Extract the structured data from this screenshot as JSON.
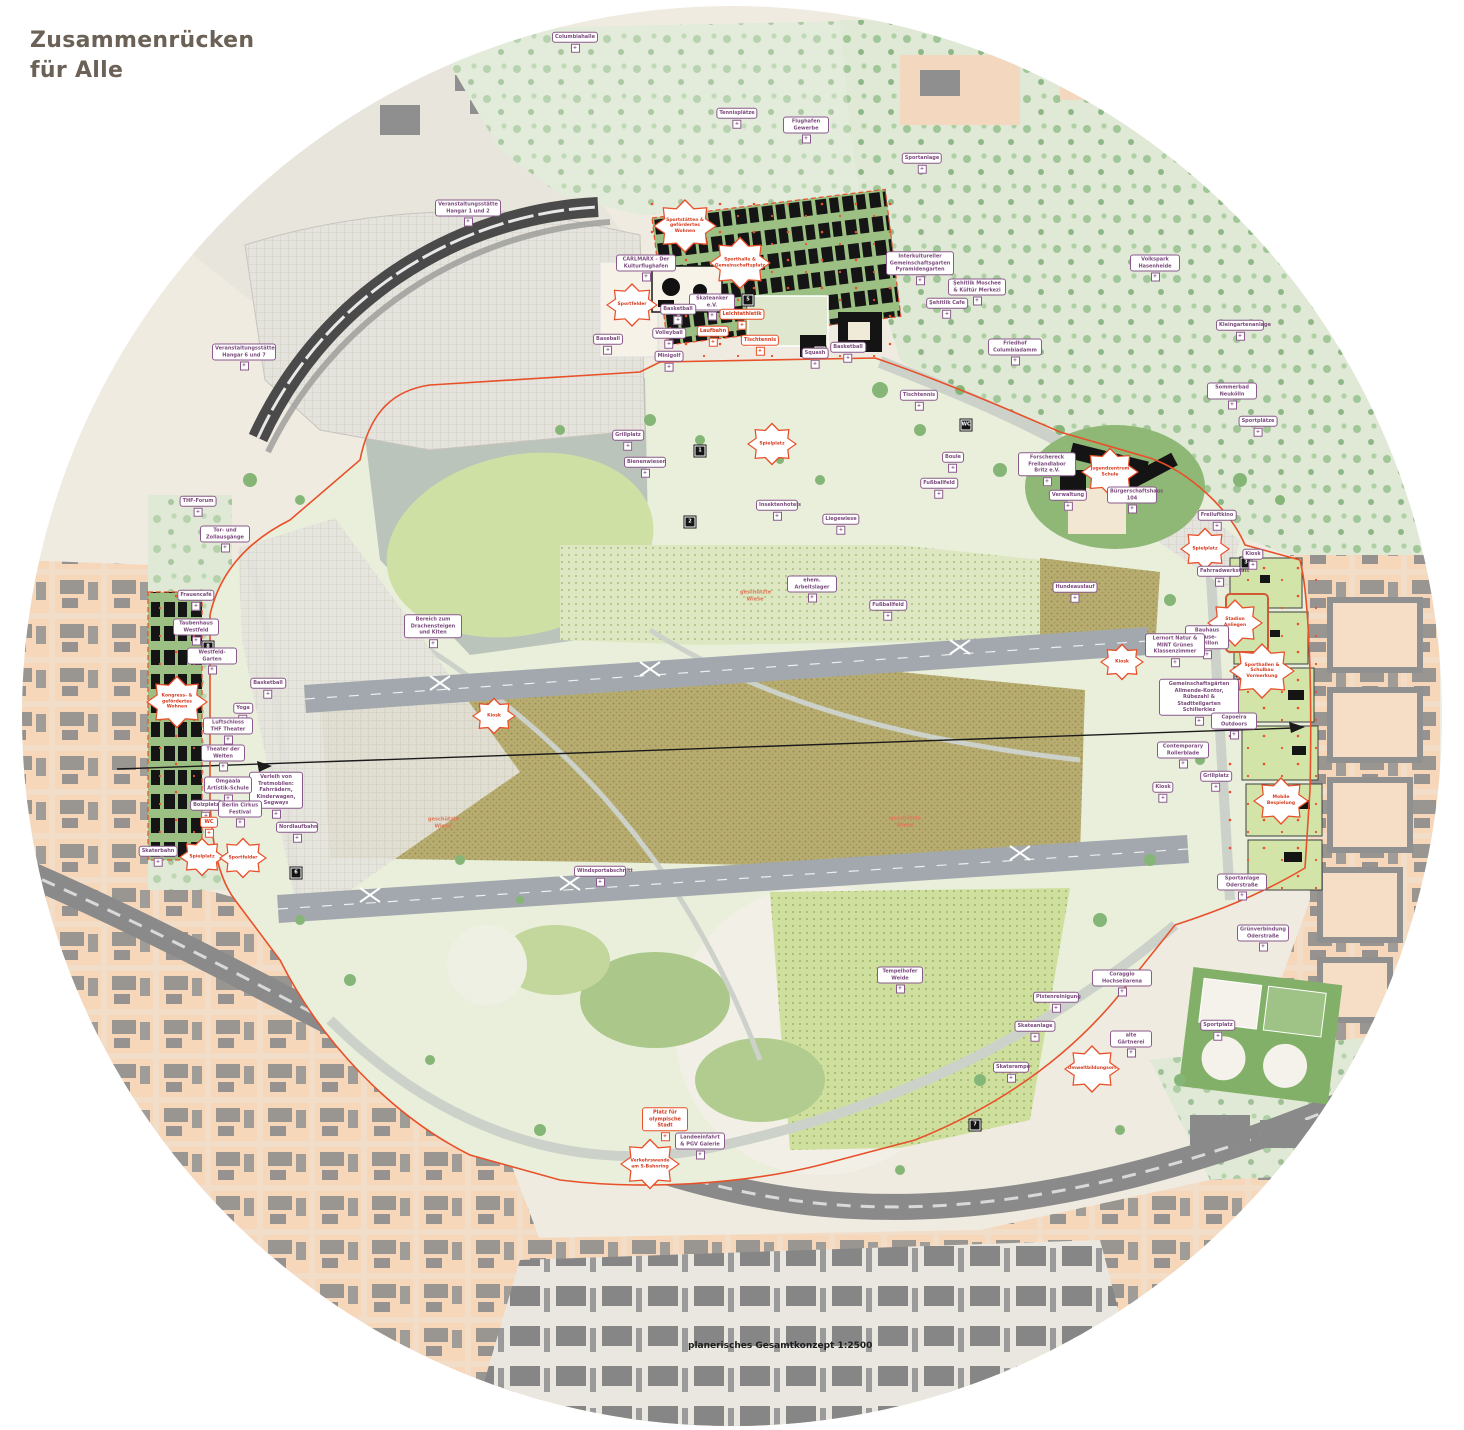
{
  "title": "Zusammenrücken\nfür Alle",
  "caption": "planerisches Gesamtkonzept  1:2500",
  "colors": {
    "accent_orange": "#e8502a",
    "label_purple": "#7b4b7d",
    "field_green": "#e9efdb",
    "meadow_brown": "#b8ad6f",
    "city_peach": "#f6d7ba",
    "title_brown": "#6b6156"
  },
  "map": {
    "labels": [
      {
        "t": "Columbiahalle",
        "x": 575,
        "y": 42,
        "k": "p"
      },
      {
        "t": "Tennisplätze",
        "x": 737,
        "y": 118,
        "k": "p"
      },
      {
        "t": "Flughafen Gewerbe",
        "x": 806,
        "y": 130,
        "k": "p",
        "w": 40
      },
      {
        "t": "Sportanlage",
        "x": 922,
        "y": 163,
        "k": "p"
      },
      {
        "t": "Volkspark Hasenheide",
        "x": 1155,
        "y": 268,
        "k": "p",
        "w": 44
      },
      {
        "t": "Kleingartenanlage",
        "x": 1240,
        "y": 330,
        "k": "p",
        "w": 42
      },
      {
        "t": "Sommerbad Neukölln",
        "x": 1232,
        "y": 396,
        "k": "p",
        "w": 44
      },
      {
        "t": "Sportplätze",
        "x": 1258,
        "y": 426,
        "k": "p"
      },
      {
        "t": "Interkultureller Gemeinschaftsgarten Pyramidengarten",
        "x": 920,
        "y": 268,
        "k": "p",
        "w": 62
      },
      {
        "t": "Şehitlik Moschee & Kültür Merkezi",
        "x": 977,
        "y": 292,
        "k": "p",
        "w": 52
      },
      {
        "t": "Şehitlik Cafe",
        "x": 947,
        "y": 308,
        "k": "p"
      },
      {
        "t": "Friedhof Columbiadamm",
        "x": 1015,
        "y": 352,
        "k": "p",
        "w": 48
      },
      {
        "t": "Veranstaltungsstätte Hangar 1 und 2",
        "x": 468,
        "y": 213,
        "k": "p",
        "w": 60
      },
      {
        "t": "Veranstaltungsstätte Hangar 6 und 7",
        "x": 244,
        "y": 357,
        "k": "p",
        "w": 58
      },
      {
        "t": "THF-Forum",
        "x": 198,
        "y": 506,
        "k": "p"
      },
      {
        "t": "Tor- und Zollausgänge",
        "x": 225,
        "y": 539,
        "k": "p",
        "w": 44
      },
      {
        "t": "Sportstätten & gefördertes Wohnen",
        "x": 685,
        "y": 226,
        "k": "b",
        "w": 46
      },
      {
        "t": "Sporthalle & Gemeinschaftsplatz",
        "x": 740,
        "y": 263,
        "k": "b",
        "w": 44
      },
      {
        "t": "CARLMARX - Der Kulturflughafen",
        "x": 646,
        "y": 268,
        "k": "p",
        "w": 54
      },
      {
        "t": "Sportfelder",
        "x": 632,
        "y": 305,
        "k": "b",
        "w": 34
      },
      {
        "t": "Skateanker e.V.",
        "x": 712,
        "y": 307,
        "k": "p",
        "w": 40
      },
      {
        "t": "Basketball",
        "x": 678,
        "y": 314,
        "k": "p"
      },
      {
        "t": "Leichtathletik",
        "x": 742,
        "y": 319,
        "k": "o"
      },
      {
        "t": "Laufbahn",
        "x": 713,
        "y": 336,
        "k": "o"
      },
      {
        "t": "Volleyball",
        "x": 669,
        "y": 338,
        "k": "p"
      },
      {
        "t": "Baseball",
        "x": 608,
        "y": 344,
        "k": "p"
      },
      {
        "t": "Tischtennis",
        "x": 760,
        "y": 345,
        "k": "o"
      },
      {
        "t": "Minigolf",
        "x": 669,
        "y": 361,
        "k": "p"
      },
      {
        "t": "Squash",
        "x": 815,
        "y": 358,
        "k": "p"
      },
      {
        "t": "Basketball",
        "x": 848,
        "y": 352,
        "k": "p"
      },
      {
        "t": "Tischtennis",
        "x": 919,
        "y": 400,
        "k": "p"
      },
      {
        "t": "Boule",
        "x": 953,
        "y": 462,
        "k": "p"
      },
      {
        "t": "Fußballfeld",
        "x": 939,
        "y": 488,
        "k": "p"
      },
      {
        "t": "Forschereck Freilandlabor Britz e.V.",
        "x": 1047,
        "y": 469,
        "k": "p",
        "w": 52
      },
      {
        "t": "Jugendzentrum Schule",
        "x": 1110,
        "y": 472,
        "k": "b",
        "w": 40
      },
      {
        "t": "Verwaltung",
        "x": 1068,
        "y": 500,
        "k": "p"
      },
      {
        "t": "Bürgerschaftshaus 104",
        "x": 1132,
        "y": 500,
        "k": "p",
        "w": 44
      },
      {
        "t": "Freiluftkino",
        "x": 1217,
        "y": 520,
        "k": "p"
      },
      {
        "t": "Spielplatz",
        "x": 1205,
        "y": 549,
        "k": "b",
        "w": 32
      },
      {
        "t": "Kiosk",
        "x": 1253,
        "y": 559,
        "k": "p"
      },
      {
        "t": "Fahrradwerkstatt",
        "x": 1219,
        "y": 576,
        "k": "p",
        "w": 38
      },
      {
        "t": "Hundeauslauf",
        "x": 1075,
        "y": 592,
        "k": "p"
      },
      {
        "t": "Kiosk",
        "x": 1122,
        "y": 662,
        "k": "b",
        "w": 26
      },
      {
        "t": "Stadion Anliegen",
        "x": 1235,
        "y": 623,
        "k": "b",
        "w": 38
      },
      {
        "t": "Bauhaus Reuse-Pavillon",
        "x": 1207,
        "y": 642,
        "k": "p",
        "w": 38
      },
      {
        "t": "Lernort Natur & MINT Grünes Klassenzimmer",
        "x": 1175,
        "y": 650,
        "k": "p",
        "w": 54
      },
      {
        "t": "Sporthallen & Schulbau Vormerkung",
        "x": 1262,
        "y": 671,
        "k": "b",
        "w": 48
      },
      {
        "t": "Gemeinschaftsgärten Allmende-Kontor, Rübezahl & Stadtteilgarten Schillerkiez",
        "x": 1199,
        "y": 702,
        "k": "p",
        "w": 74
      },
      {
        "t": "Capoeira Outdoors",
        "x": 1234,
        "y": 726,
        "k": "p",
        "w": 40
      },
      {
        "t": "Contemporary Rollerblade",
        "x": 1183,
        "y": 755,
        "k": "p",
        "w": 46
      },
      {
        "t": "Grillplatz",
        "x": 1216,
        "y": 781,
        "k": "p"
      },
      {
        "t": "Mobile Bespielung",
        "x": 1281,
        "y": 801,
        "k": "b",
        "w": 38
      },
      {
        "t": "Kiosk",
        "x": 1163,
        "y": 792,
        "k": "p"
      },
      {
        "t": "Sportanlage Oderstraße",
        "x": 1242,
        "y": 887,
        "k": "p",
        "w": 44
      },
      {
        "t": "Grünverbindung Oderstraße",
        "x": 1263,
        "y": 938,
        "k": "p",
        "w": 46
      },
      {
        "t": "Tempelhofer Weide",
        "x": 900,
        "y": 980,
        "k": "p",
        "w": 40
      },
      {
        "t": "Coraggio Hochseilarena",
        "x": 1122,
        "y": 983,
        "k": "p",
        "w": 54
      },
      {
        "t": "Pistenreinigung",
        "x": 1056,
        "y": 1002,
        "k": "p",
        "w": 40
      },
      {
        "t": "Skateanlage",
        "x": 1035,
        "y": 1031,
        "k": "p"
      },
      {
        "t": "alte Gärtnerei",
        "x": 1131,
        "y": 1044,
        "k": "p",
        "w": 36
      },
      {
        "t": "Umweltbildungsort",
        "x": 1092,
        "y": 1069,
        "k": "b",
        "w": 38
      },
      {
        "t": "Skaterampe",
        "x": 1011,
        "y": 1072,
        "k": "p",
        "w": 30
      },
      {
        "t": "Sportplatz",
        "x": 1218,
        "y": 1030,
        "k": "p"
      },
      {
        "t": "Platz für olympische Stadt",
        "x": 665,
        "y": 1124,
        "k": "o",
        "w": 40
      },
      {
        "t": "Landeeinfahrt & PGV Galerie",
        "x": 700,
        "y": 1146,
        "k": "p",
        "w": 44
      },
      {
        "t": "Verkehrswende am S-Bahnring",
        "x": 650,
        "y": 1164,
        "k": "b",
        "w": 42
      },
      {
        "t": "Frauencafé",
        "x": 196,
        "y": 600,
        "k": "p"
      },
      {
        "t": "Taubenhaus Westfeld",
        "x": 196,
        "y": 632,
        "k": "p",
        "w": 40
      },
      {
        "t": "Westfeld-Garten",
        "x": 212,
        "y": 661,
        "k": "p",
        "w": 44
      },
      {
        "t": "Kongress- & gefördertes Wohnen",
        "x": 177,
        "y": 702,
        "k": "b",
        "w": 44
      },
      {
        "t": "Basketball",
        "x": 268,
        "y": 688,
        "k": "p"
      },
      {
        "t": "Yoga",
        "x": 243,
        "y": 713,
        "k": "p"
      },
      {
        "t": "Luftschloss THF Theater",
        "x": 228,
        "y": 731,
        "k": "p",
        "w": 44
      },
      {
        "t": "Theater der Welten",
        "x": 223,
        "y": 758,
        "k": "p",
        "w": 38
      },
      {
        "t": "Verleih von Tretmobilen: Fahrrädern, Kinderwagen, Segways",
        "x": 276,
        "y": 795,
        "k": "p",
        "w": 48
      },
      {
        "t": "Omgaala Artistik-Schule",
        "x": 228,
        "y": 790,
        "k": "p",
        "w": 42
      },
      {
        "t": "Bolzplatz",
        "x": 206,
        "y": 810,
        "k": "p"
      },
      {
        "t": "Berlin Cirkus Festival",
        "x": 240,
        "y": 814,
        "k": "p",
        "w": 38
      },
      {
        "t": "Nordlaufbahn",
        "x": 297,
        "y": 832,
        "k": "p",
        "w": 36
      },
      {
        "t": "WC",
        "x": 209,
        "y": 827,
        "k": "o",
        "w": 12
      },
      {
        "t": "Skaterbahn",
        "x": 158,
        "y": 856,
        "k": "p"
      },
      {
        "t": "Spielplatz",
        "x": 202,
        "y": 857,
        "k": "b",
        "w": 28
      },
      {
        "t": "Sportfelder",
        "x": 243,
        "y": 858,
        "k": "b",
        "w": 30
      },
      {
        "t": "Grillplatz",
        "x": 628,
        "y": 440,
        "k": "p"
      },
      {
        "t": "Bienenwiesen",
        "x": 645,
        "y": 467,
        "k": "p",
        "w": 36
      },
      {
        "t": "Spielplatz",
        "x": 772,
        "y": 444,
        "k": "b",
        "w": 32
      },
      {
        "t": "Insektenhotels",
        "x": 777,
        "y": 510,
        "k": "p",
        "w": 36
      },
      {
        "t": "Liegewiese",
        "x": 841,
        "y": 524,
        "k": "p"
      },
      {
        "t": "ehem. Arbeitslager",
        "x": 812,
        "y": 589,
        "k": "p",
        "w": 44
      },
      {
        "t": "geschützte Wiese",
        "x": 755,
        "y": 596,
        "k": "f",
        "w": 30
      },
      {
        "t": "Bereich zum Drachensteigen und Kiten",
        "x": 433,
        "y": 631,
        "k": "p",
        "w": 52
      },
      {
        "t": "Fußballfeld",
        "x": 888,
        "y": 610,
        "k": "p"
      },
      {
        "t": "Kiosk",
        "x": 494,
        "y": 716,
        "k": "b",
        "w": 26
      },
      {
        "t": "geschützte Wiese",
        "x": 443,
        "y": 823,
        "k": "f",
        "w": 30
      },
      {
        "t": "geschützte Wiese",
        "x": 905,
        "y": 822,
        "k": "f",
        "w": 30
      },
      {
        "t": "Windsportabschnitt",
        "x": 600,
        "y": 876,
        "k": "p",
        "w": 46
      }
    ],
    "markers": [
      {
        "x": 700,
        "y": 451,
        "n": "1"
      },
      {
        "x": 690,
        "y": 522,
        "n": "2"
      },
      {
        "x": 966,
        "y": 425,
        "n": "WC"
      },
      {
        "x": 1246,
        "y": 563,
        "n": "3"
      },
      {
        "x": 820,
        "y": 352,
        "n": "4"
      },
      {
        "x": 748,
        "y": 300,
        "n": "5"
      },
      {
        "x": 296,
        "y": 873,
        "n": "6"
      },
      {
        "x": 975,
        "y": 1125,
        "n": "7"
      },
      {
        "x": 208,
        "y": 647,
        "n": "8"
      },
      {
        "x": 1240,
        "y": 673,
        "n": "9"
      }
    ]
  }
}
